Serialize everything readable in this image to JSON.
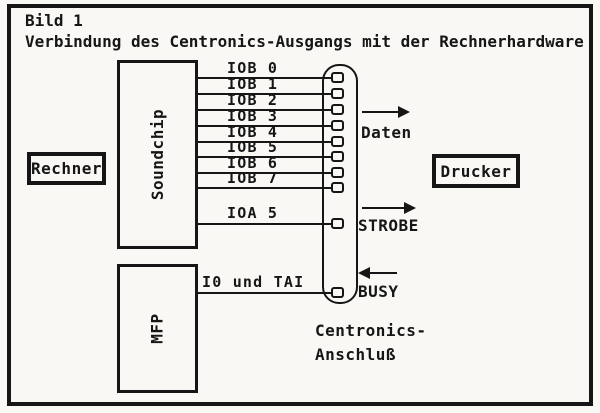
{
  "colors": {
    "ink": "#161616",
    "paper": "#f9f8f4"
  },
  "title": {
    "line1": "Bild 1",
    "line2": "Verbindung des Centronics-Ausgangs mit der Rechnerhardware"
  },
  "boxes": {
    "rechner": "Rechner",
    "drucker": "Drucker",
    "soundchip": "Soundchip",
    "mfp": "MFP"
  },
  "wires": {
    "soundchip_data": [
      "IOB 0",
      "IOB 1",
      "IOB 2",
      "IOB 3",
      "IOB 4",
      "IOB 5",
      "IOB 6",
      "IOB 7"
    ],
    "soundchip_strobe": "IOA 5",
    "mfp_busy": "I0 und TAI"
  },
  "connector": {
    "caption_line1": "Centronics-",
    "caption_line2": "Anschluß",
    "pin_count": 10
  },
  "flows": {
    "daten": {
      "label": "Daten",
      "direction": "right"
    },
    "strobe": {
      "label": "STROBE",
      "direction": "right"
    },
    "busy": {
      "label": "BUSY",
      "direction": "left"
    }
  }
}
